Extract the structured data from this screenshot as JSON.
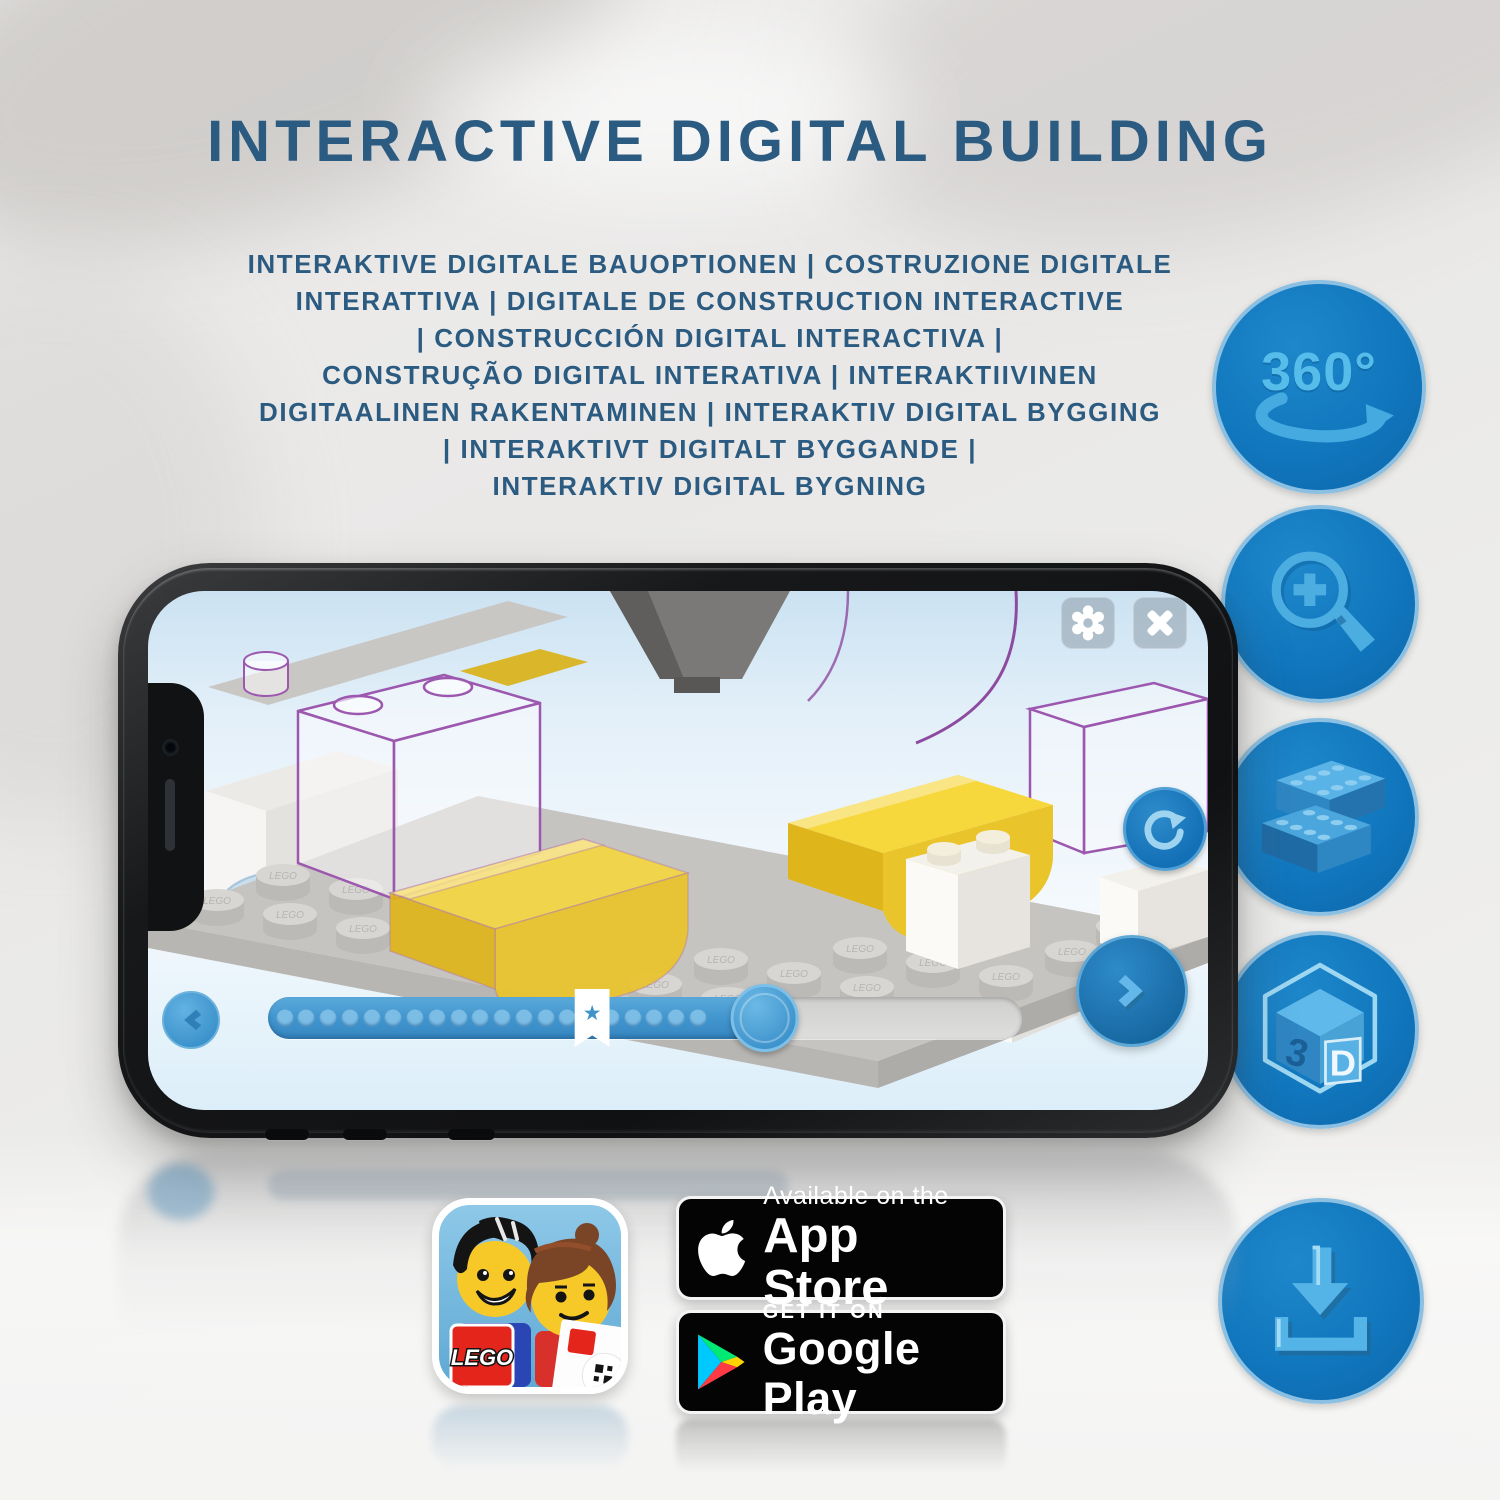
{
  "header": {
    "title": "INTERACTIVE DIGITAL BUILDING",
    "subtitle_lines": [
      "INTERAKTIVE DIGITALE BAUOPTIONEN | COSTRUZIONE DIGITALE",
      "INTERATTIVA | DIGITALE DE CONSTRUCTION INTERACTIVE",
      "| CONSTRUCCIÓN DIGITAL INTERACTIVA |",
      "CONSTRUÇÃO DIGITAL INTERATIVA | INTERAKTIIVINEN",
      "DIGITAALINEN RAKENTAMINEN | INTERAKTIV DIGITAL BYGGING",
      "| INTERAKTIVT DIGITALT BYGGANDE |",
      "INTERAKTIV DIGITAL BYGNING"
    ]
  },
  "features": {
    "rotation_label": "360°",
    "cube_left": "3",
    "cube_right": "D",
    "icon_names": [
      "360-rotation",
      "zoom-in",
      "building-bricks",
      "3d-view",
      "download"
    ],
    "circle_color": "#1177be",
    "glyph_color": "#4db1e6"
  },
  "phone": {
    "scene": {
      "stud_text": "LEGO",
      "brick_yellow": "#f4d642",
      "plate_gray": "#c6c4c1",
      "ghost_outline": "#9c57ae"
    },
    "progress": {
      "dot_count": 20,
      "fill_percent": 66,
      "bookmark_percent": 43,
      "star": "★"
    }
  },
  "badges": {
    "lego_logo": "LEGO",
    "app_store": {
      "line1": "Available on the",
      "line2": "App Store"
    },
    "google_play": {
      "line1": "GET IT ON",
      "line2": "Google Play"
    }
  },
  "colors": {
    "title_blue": "#2b5b80",
    "accent_blue": "#1177be"
  }
}
